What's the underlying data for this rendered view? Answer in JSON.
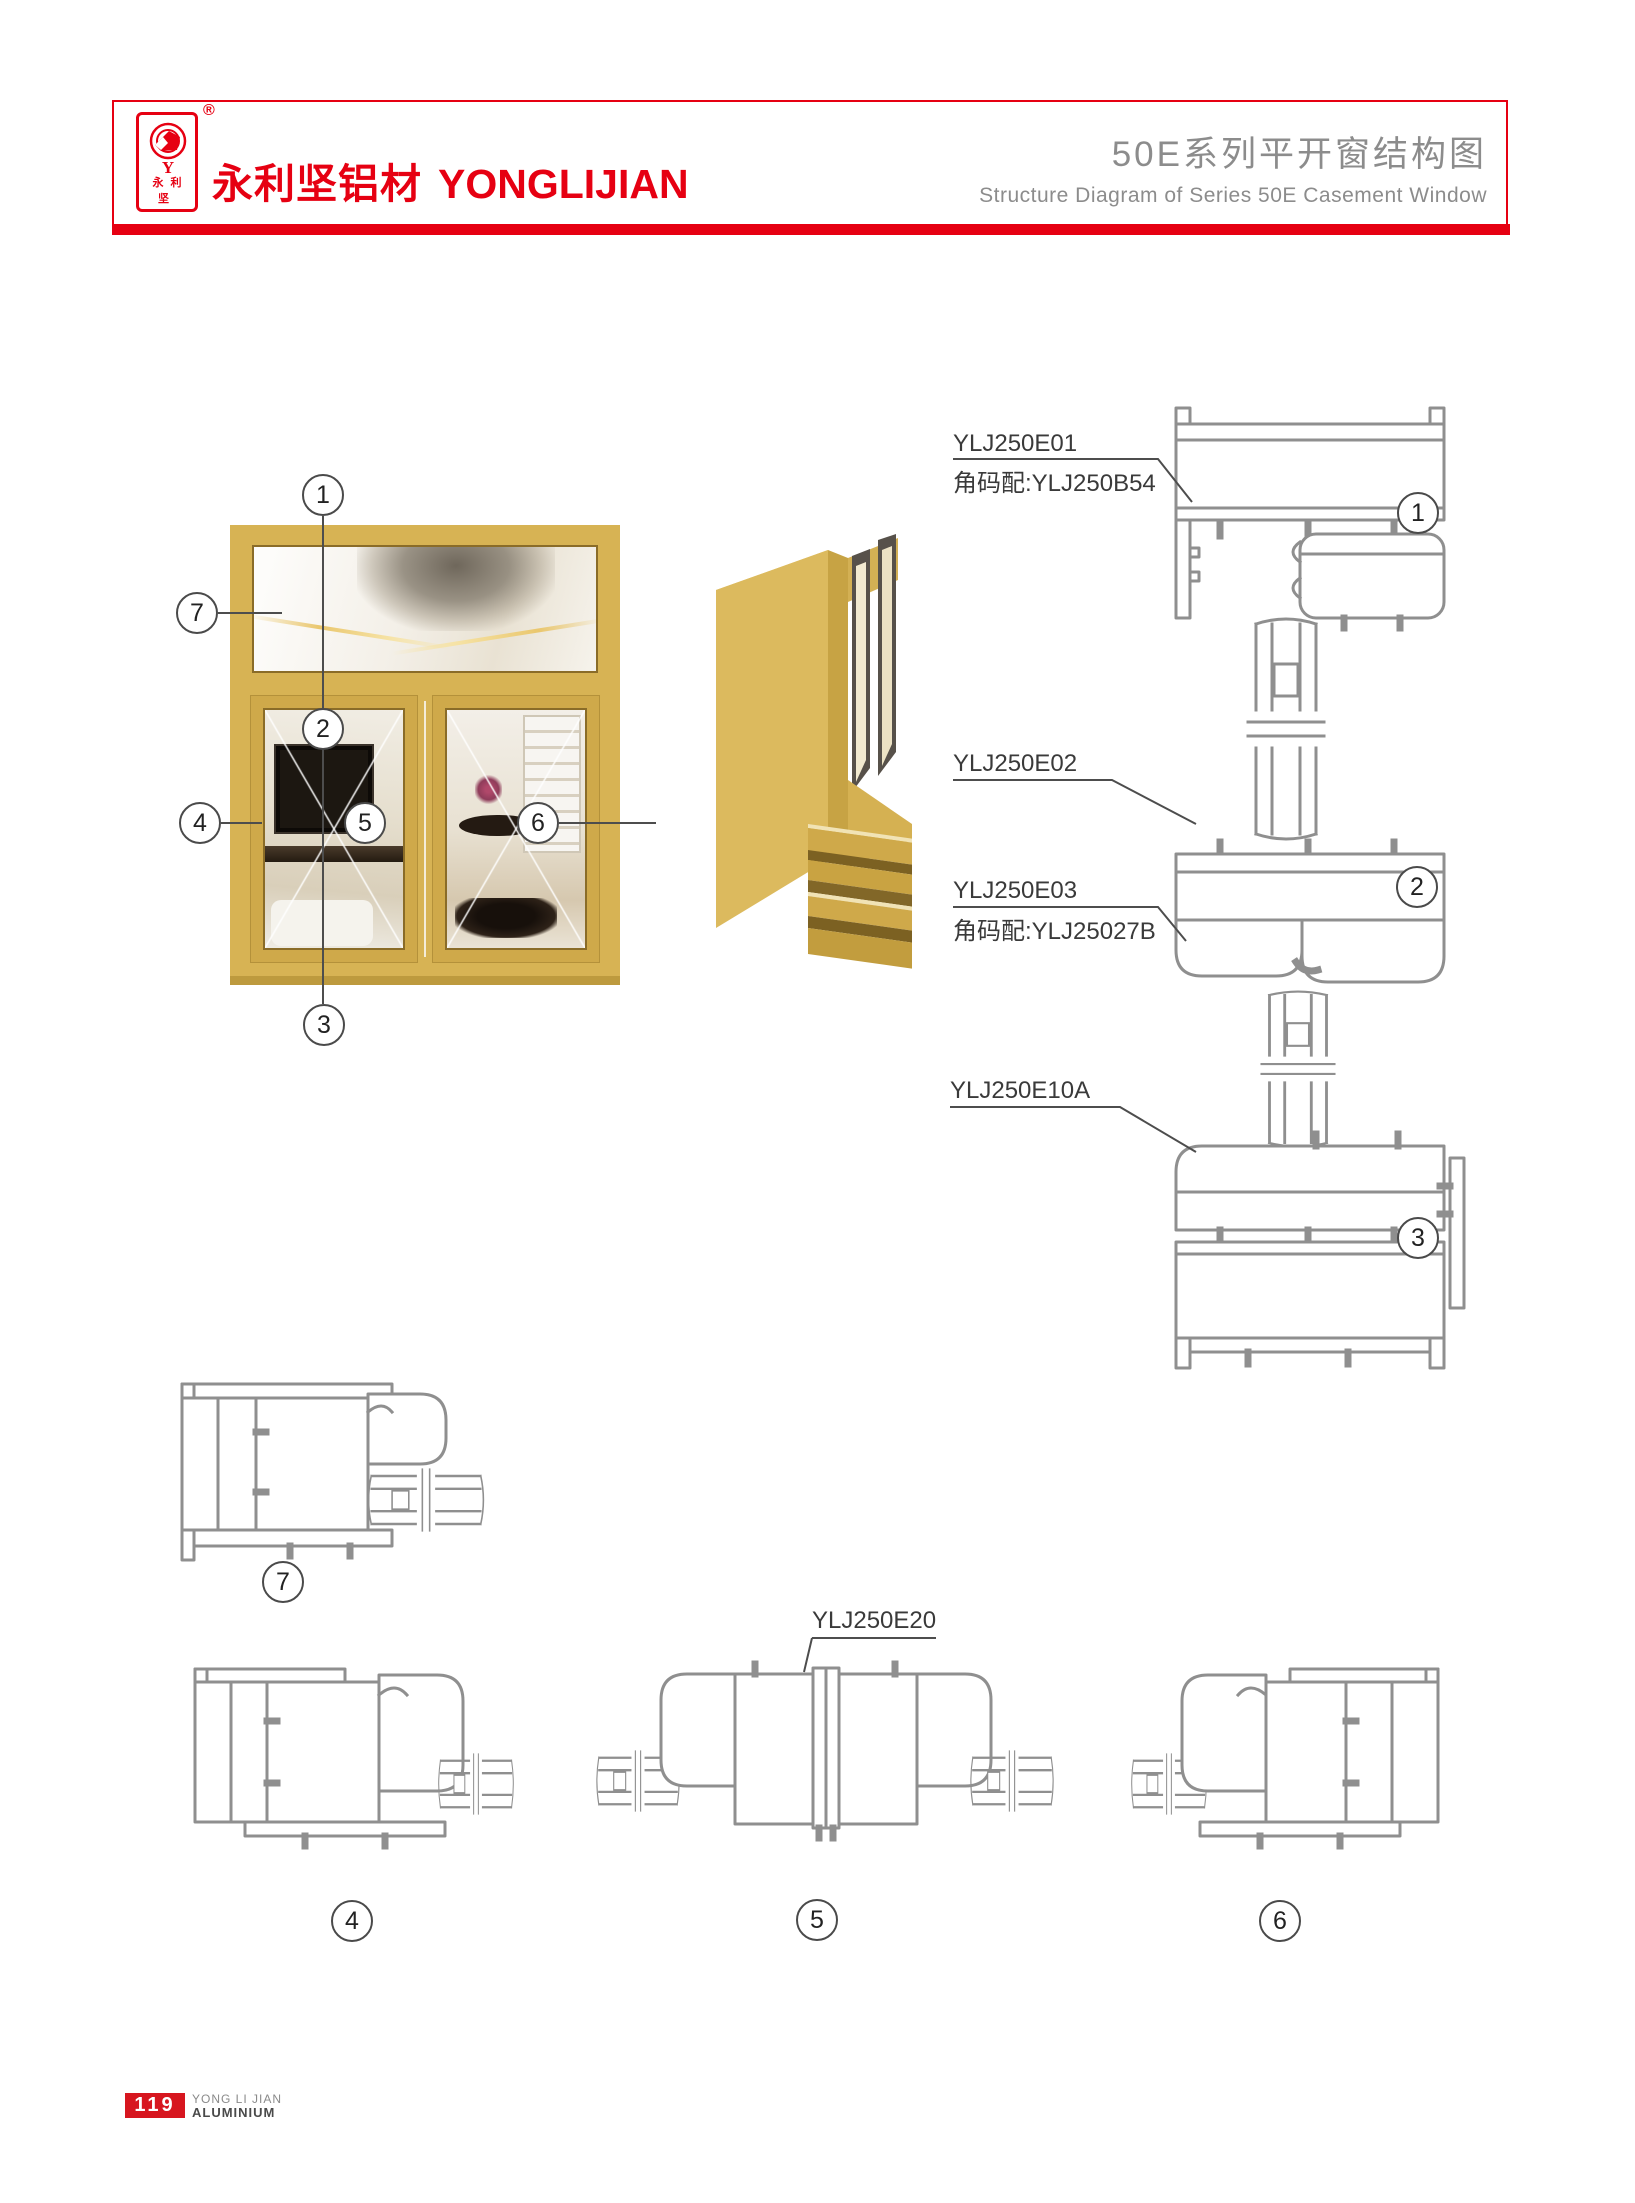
{
  "header": {
    "logo_monogram": "Y",
    "logo_chars": "永利坚",
    "registered_mark": "®",
    "brand_cn": "永利坚铝材",
    "brand_en": "YONGLIJIAN",
    "title_cn": "50E系列平开窗结构图",
    "title_en": "Structure Diagram of Series 50E Casement Window"
  },
  "diagram": {
    "callouts": {
      "c1": "1",
      "c2": "2",
      "c3": "3",
      "c4": "4",
      "c5": "5",
      "c6": "6",
      "c7": "7"
    },
    "part_labels": {
      "e01": "YLJ250E01",
      "e01_corner": "角码配:YLJ250B54",
      "e02": "YLJ250E02",
      "e03": "YLJ250E03",
      "e03_corner": "角码配:YLJ25027B",
      "e10a": "YLJ250E10A",
      "e20": "YLJ250E20"
    }
  },
  "footer": {
    "page_number": "119",
    "brand_line1": "YONG LI JIAN",
    "brand_line2": "ALUMINIUM"
  },
  "colors": {
    "accent_red": "#e60012",
    "title_gray": "#8c8c8c",
    "drawing_gray": "#8f8f8f",
    "frame_gold": "#d7b354"
  }
}
